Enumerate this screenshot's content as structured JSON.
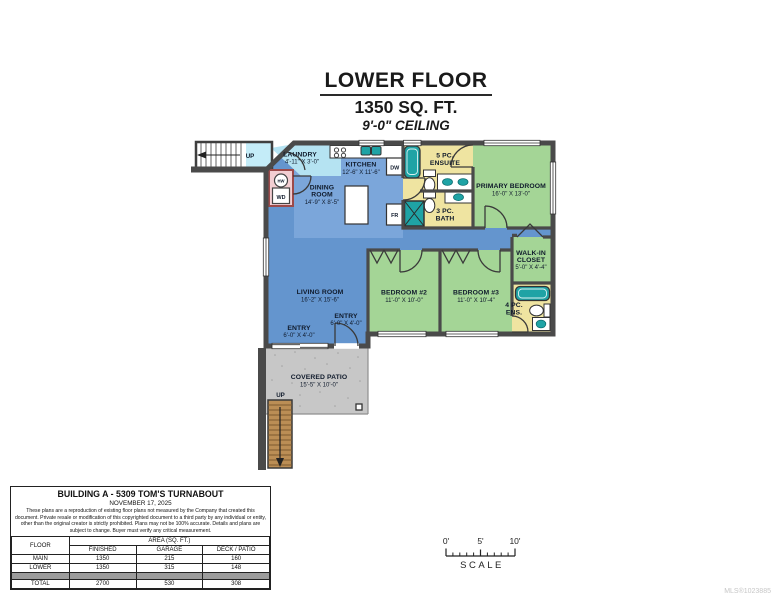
{
  "title": {
    "floor": "LOWER FLOOR",
    "area": "1350 SQ. FT.",
    "ceiling": "9'-0\" CEILING"
  },
  "rooms": {
    "laundry": {
      "name": "LAUNDRY",
      "dims": "4'-11\" X 3'-0\""
    },
    "kitchen": {
      "name": "KITCHEN",
      "dims": "12'-6\" X 11'-6\""
    },
    "dining": {
      "name1": "DINING",
      "name2": "ROOM",
      "dims": "14'-9\" X 8'-5\""
    },
    "ensuite": {
      "name1": "5 PC.",
      "name2": "ENSUITE"
    },
    "bath": {
      "name1": "3 PC.",
      "name2": "BATH"
    },
    "primary": {
      "name": "PRIMARY BEDROOM",
      "dims": "16'-0\" X 13'-0\""
    },
    "walkin": {
      "name1": "WALK-IN",
      "name2": "CLOSET",
      "dims": "5'-0\" X 4'-4\""
    },
    "ens4": {
      "name1": "4 PC.",
      "name2": "ENS."
    },
    "living": {
      "name": "LIVING ROOM",
      "dims": "16'-2\" X 15'-6\""
    },
    "bedroom2": {
      "name": "BEDROOM #2",
      "dims": "11'-0\" X 10'-0\""
    },
    "bedroom3": {
      "name": "BEDROOM #3",
      "dims": "11'-0\" X 10'-4\""
    },
    "entry_inner": {
      "name": "ENTRY",
      "dims": "6'-0\" X 4'-0\""
    },
    "entry_outer": {
      "name": "ENTRY",
      "dims": "6'-0\" X 4'-0\""
    },
    "patio": {
      "name": "COVERED PATIO",
      "dims": "15'-5\" X 10'-0\""
    }
  },
  "labels": {
    "up_top": "UP",
    "up_bottom": "UP",
    "dw": "DW",
    "fr": "FR",
    "wd": "WD",
    "hw": "HW"
  },
  "info_box": {
    "title": "BUILDING A - 5309 TOM'S TURNABOUT",
    "date": "NOVEMBER 17, 2025",
    "disclaimer": "These plans are a reproduction of existing floor plans not measured by the Company that created this document. Private resale or modification of this copyrighted document to a third party by any individual or entity, other than the original creator is strictly prohibited. Plans may not be 100% accurate. Details and plans are subject to change. Buyer must verify any critical measurement.",
    "table": {
      "floor_header": "FLOOR",
      "area_header": "AREA (SQ. FT.)",
      "sub_headers": [
        "FINISHED",
        "GARAGE",
        "DECK / PATIO"
      ],
      "rows": [
        {
          "label": "MAIN",
          "values": [
            "1350",
            "215",
            "160"
          ]
        },
        {
          "label": "LOWER",
          "values": [
            "1350",
            "315",
            "148"
          ]
        },
        {
          "label": "TOTAL",
          "values": [
            "2700",
            "530",
            "308"
          ]
        }
      ]
    }
  },
  "scale_bar": {
    "tick0": "0'",
    "tick5": "5'",
    "tick10": "10'",
    "label": "SCALE"
  },
  "watermark": "MLS®1023885",
  "colors": {
    "wall": "#4a4a4a",
    "room_blue": "#6495ce",
    "room_blue_light": "#7ba6da",
    "laundry_cyan": "#b5e3f2",
    "room_green": "#a4d596",
    "room_yellow": "#efe4a1",
    "fixture_teal": "#1fa3a5",
    "patio_gray": "#c7c7c7",
    "stairs_brown": "#bb8e55",
    "closet_pink": "#f3ced2"
  }
}
